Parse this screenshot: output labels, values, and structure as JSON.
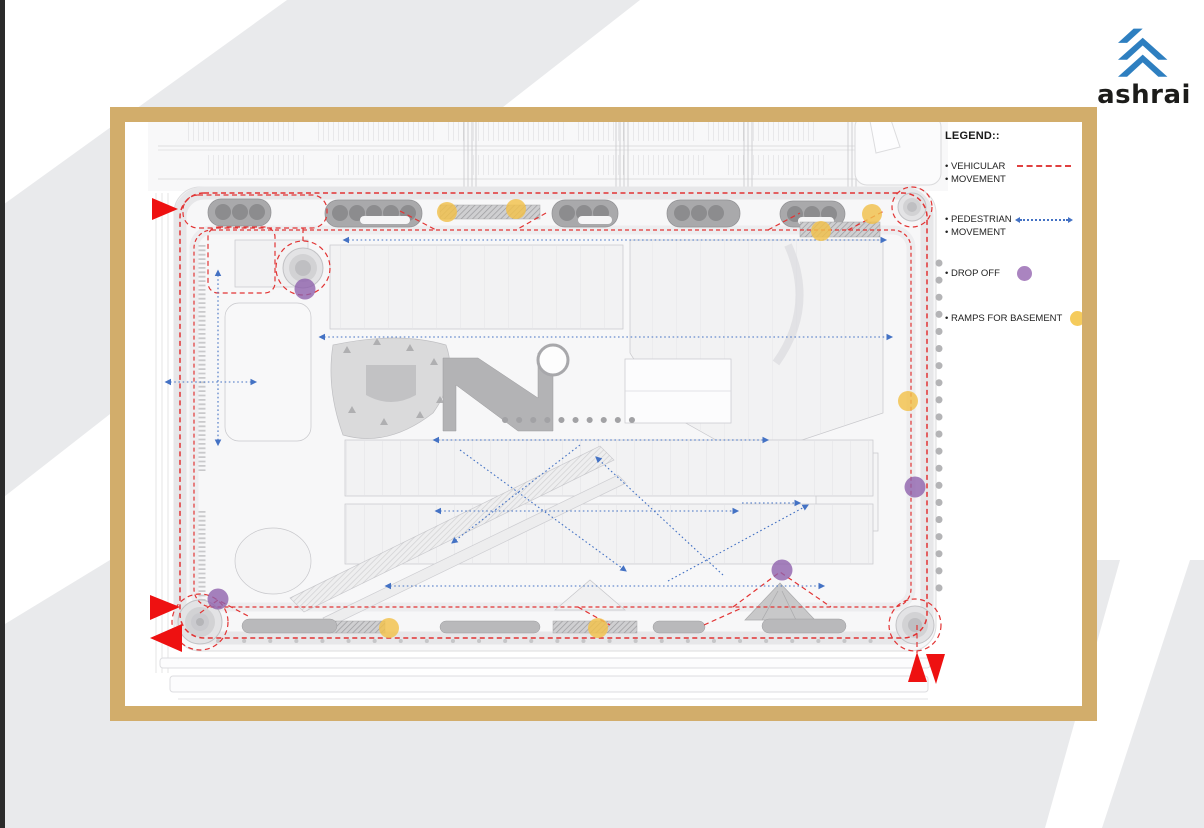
{
  "logo": {
    "text": "ashrai",
    "brand_color": "#2e7fc0"
  },
  "legend": {
    "title": "LEGEND::",
    "items": [
      {
        "line1": "• VEHICULAR",
        "line2": "• MOVEMENT",
        "symbol": "red-dashed-line",
        "color": "#e04040"
      },
      {
        "line1": "• PEDESTRIAN",
        "line2": "• MOVEMENT",
        "symbol": "blue-dotted-arrow",
        "color": "#4472c4"
      },
      {
        "line1": "• DROP OFF",
        "symbol": "purple-circle",
        "color": "#9b6fb5"
      },
      {
        "line1": "• RAMPS FOR BASEMENT",
        "symbol": "yellow-circle",
        "color": "#f4c54a"
      }
    ]
  },
  "colors": {
    "frame_gold": "#d2ad6b",
    "vehicular_red": "#e03030",
    "pedestrian_blue": "#4472c4",
    "drop_off_purple": "#9b6fb5",
    "ramp_yellow": "#f4c54a",
    "background_chevron_gray": "#e9eaec"
  }
}
